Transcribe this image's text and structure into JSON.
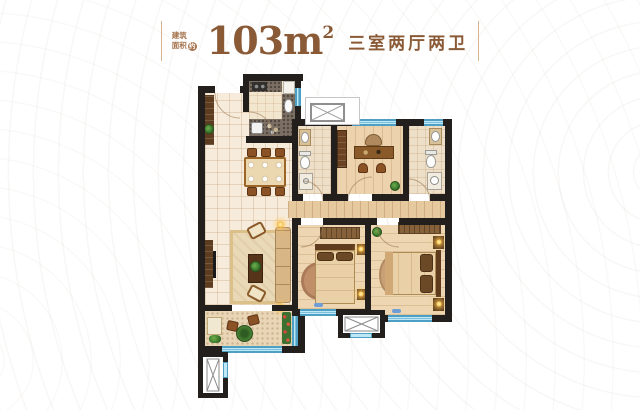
{
  "header": {
    "area_label_line1": "建筑",
    "area_label_line2": "面积",
    "area_label_approx": "约",
    "area_value": "103",
    "area_unit": "m",
    "area_exponent": "2",
    "layout_text": "三室两厅两卫"
  },
  "palette": {
    "accent_text_brown": "#8a5a36",
    "wall_black": "#221f1c",
    "window_blue": "#bfe7f6",
    "window_frame_blue": "#4e9fc4",
    "floor_cream": "#f7ecdc",
    "floor_wood": "#ecd3ad",
    "furniture_brown": "#8a5225",
    "plant_green": "#2f6b25",
    "lamp_glow_yellow": "#f5b93c"
  },
  "icons": {
    "duct_shaft_icon": "boxed X (flue/duct symbol)",
    "elevator_shaft_icon": "boxed X (building core symbol)"
  }
}
